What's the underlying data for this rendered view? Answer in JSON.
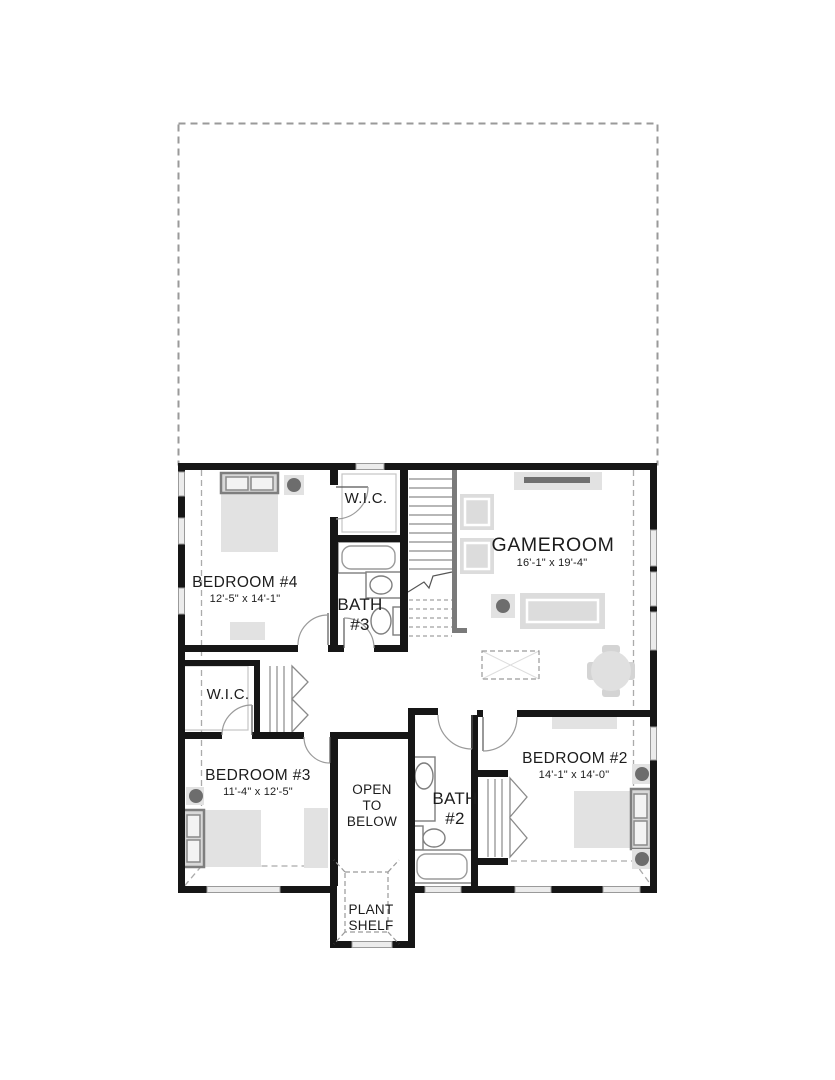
{
  "plan_type": "second-floor-plan",
  "colors": {
    "wall": "#161616",
    "window_fill": "#ececec",
    "furniture_fill": "#e2e2e2",
    "furniture_dark": "#d8d8d8",
    "fixture_outline": "#7e7e7e",
    "lamp": "#6d6d6d",
    "dashed_line": "#a9a9a9",
    "text": "#1c1c1c"
  },
  "rooms": {
    "bedroom4": {
      "name": "BEDROOM #4",
      "dims": "12'-5\" x 14'-1\""
    },
    "wic_bedroom4": {
      "name": "W.I.C."
    },
    "bath3": {
      "line1": "BATH",
      "line2": "#3"
    },
    "gameroom": {
      "name": "GAMEROOM",
      "dims": "16'-1\" x 19'-4\""
    },
    "wic_bedroom3": {
      "name": "W.I.C."
    },
    "bedroom3": {
      "name": "BEDROOM #3",
      "dims": "11'-4\" x 12'-5\""
    },
    "open_to_below": {
      "line1": "OPEN",
      "line2": "TO",
      "line3": "BELOW"
    },
    "bath2": {
      "line1": "BATH",
      "line2": "#2"
    },
    "bedroom2": {
      "name": "BEDROOM #2",
      "dims": "14'-1\" x 14'-0\""
    },
    "plant_shelf": {
      "line1": "PLANT",
      "line2": "SHELF"
    }
  }
}
